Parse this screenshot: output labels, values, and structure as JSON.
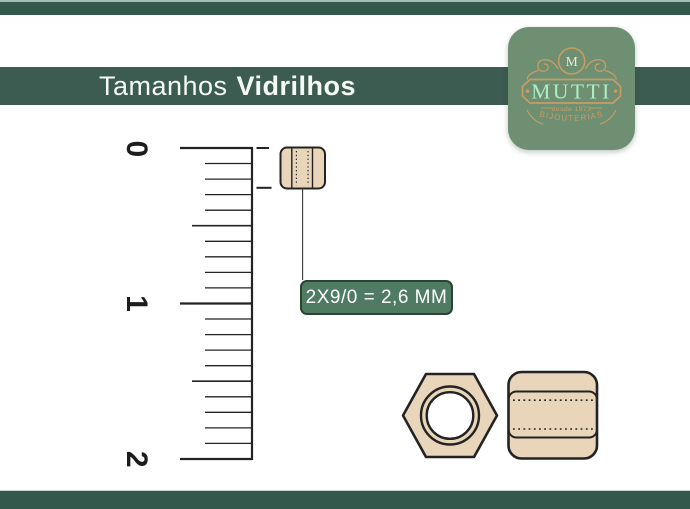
{
  "header": {
    "title_light": "Tamanhos",
    "title_bold": "Vidrilhos"
  },
  "logo": {
    "monogram": "M",
    "brand": "MUTTI",
    "since": "desde 1973",
    "tagline": "BIJOUTERIAS"
  },
  "ruler": {
    "numbers": [
      "0",
      "1",
      "2"
    ]
  },
  "size_label": {
    "text": "2X9/0 = 2,6 MM"
  },
  "colors": {
    "bar_green": "#35584d",
    "banner_green": "#3c5c51",
    "label_green": "#4e7b61",
    "logo_green": "#6f8f72",
    "gold": "#c79d62",
    "mint": "#aeeec6",
    "cream": "#f2e9d4",
    "bead_tan": "#e9d5ba",
    "outline": "#232323"
  }
}
